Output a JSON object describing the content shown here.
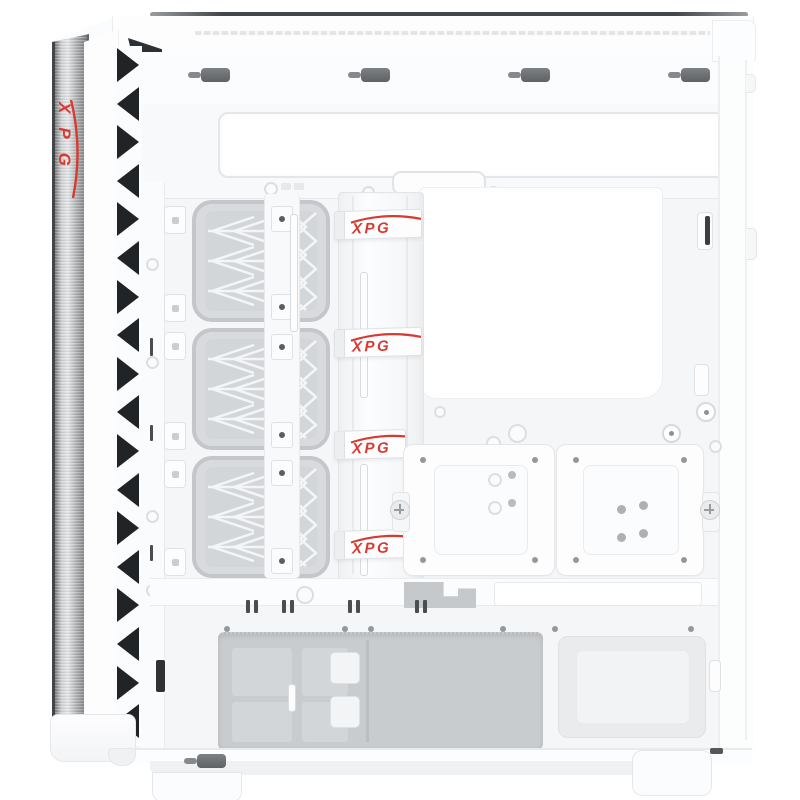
{
  "product": {
    "brand": "XPG",
    "side_logo": "XPG",
    "straps": [
      "XPG",
      "XPG",
      "XPG",
      "XPG"
    ]
  },
  "colors": {
    "brand_red": "#d63a31",
    "case_white": "#fdfdfe",
    "tray_gray": "#f5f6f8",
    "recess_gray": "#c9cccf",
    "slot_dark": "#64686c",
    "vent_dark": "#212427",
    "aluminum_mid": "#b7b9bb"
  }
}
